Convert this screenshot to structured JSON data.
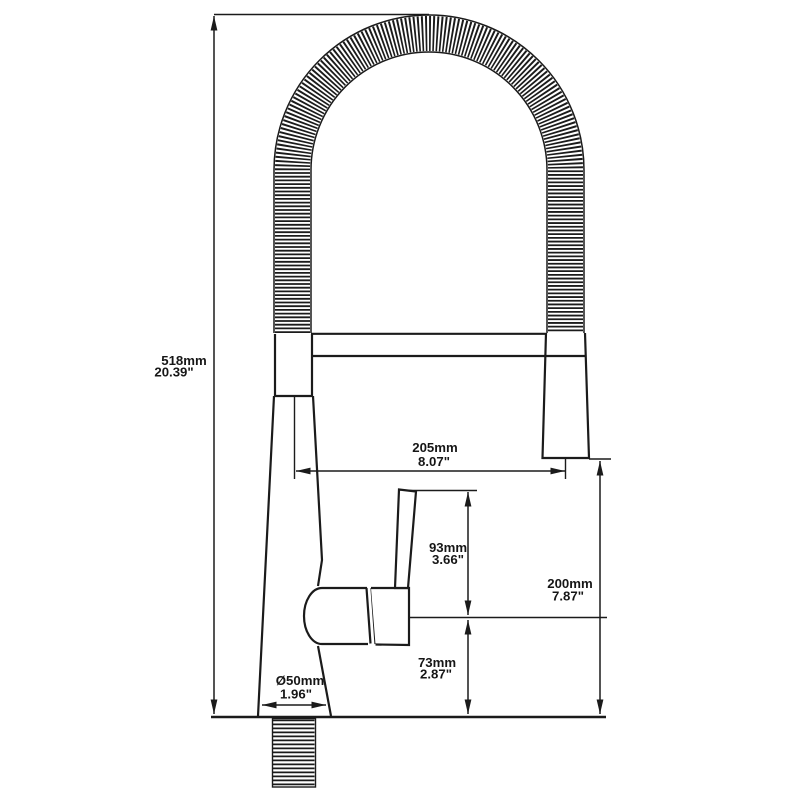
{
  "diagram": {
    "title": "Pull-down kitchen faucet dimension drawing",
    "background_color": "#ffffff",
    "line_color": "#1b1b1b",
    "dimensions": {
      "overall_height": {
        "metric": "518mm",
        "imperial": "20.39\""
      },
      "spout_reach": {
        "metric": "205mm",
        "imperial": "8.07\""
      },
      "handle_height": {
        "metric": "93mm",
        "imperial": "3.66\""
      },
      "outlet_height": {
        "metric": "200mm",
        "imperial": "7.87\""
      },
      "body_height": {
        "metric": "73mm",
        "imperial": "2.87\""
      },
      "base_diameter": {
        "metric": "Ø50mm",
        "imperial": "1.96\""
      }
    }
  }
}
